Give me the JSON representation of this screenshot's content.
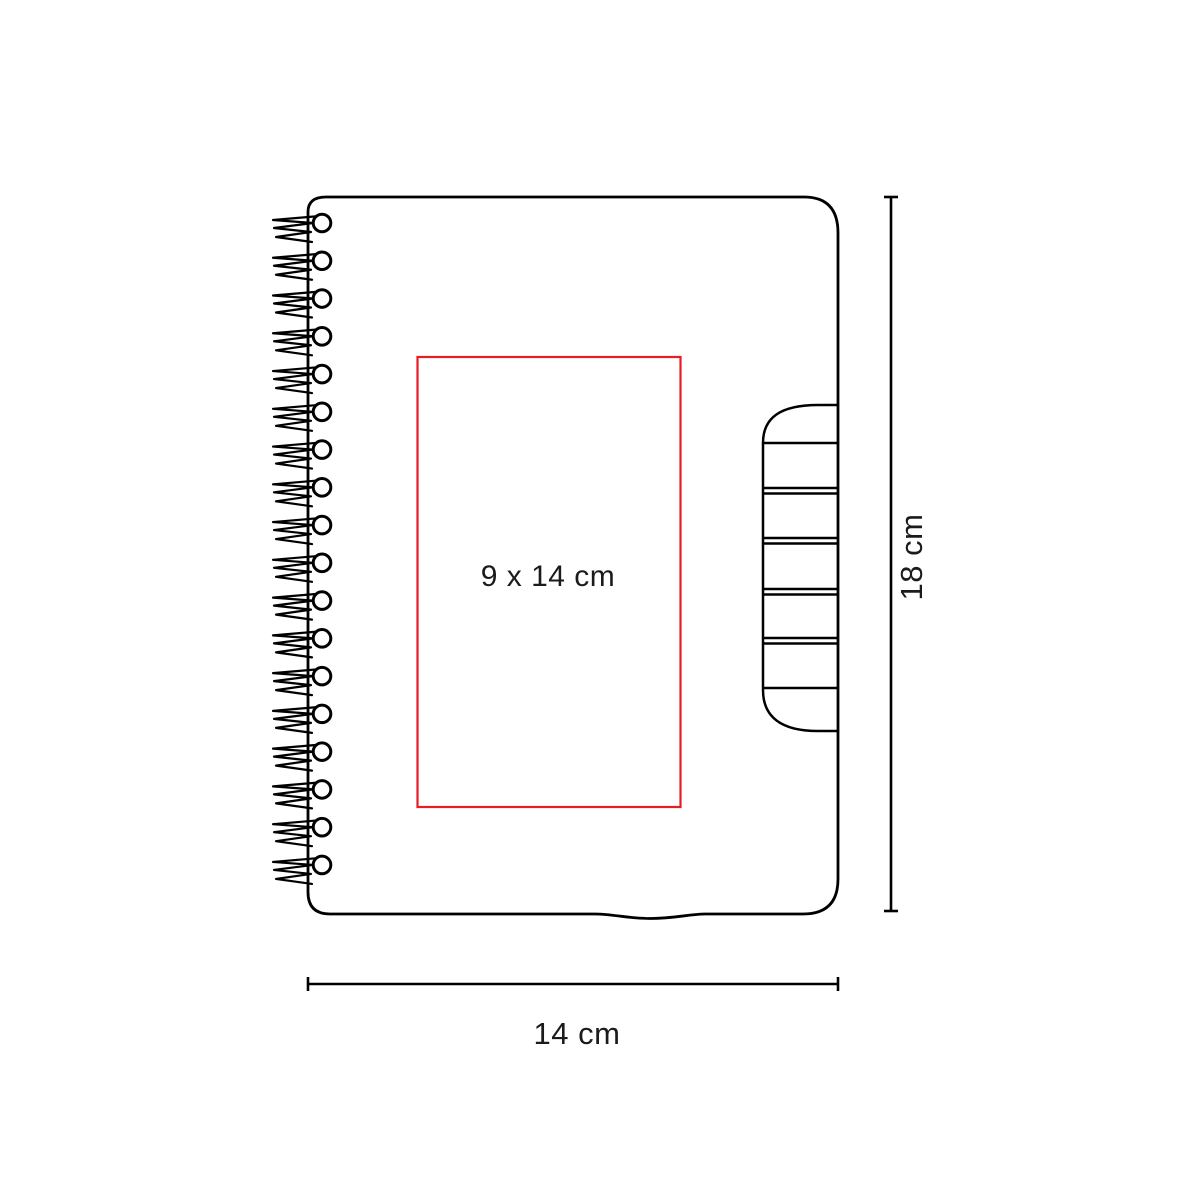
{
  "canvas": {
    "width": 1182,
    "height": 1200,
    "background": "#ffffff"
  },
  "colors": {
    "ink": "#000000",
    "label": "#1b1b1b",
    "print_area": "#e81c24"
  },
  "notebook": {
    "kind": "spiral-notebook-dimension-diagram",
    "spiral_coil_count": 18,
    "tab_band_count": 5
  },
  "labels": {
    "print_area": "9 x 14 cm",
    "height": "18 cm",
    "width": "14 cm"
  }
}
